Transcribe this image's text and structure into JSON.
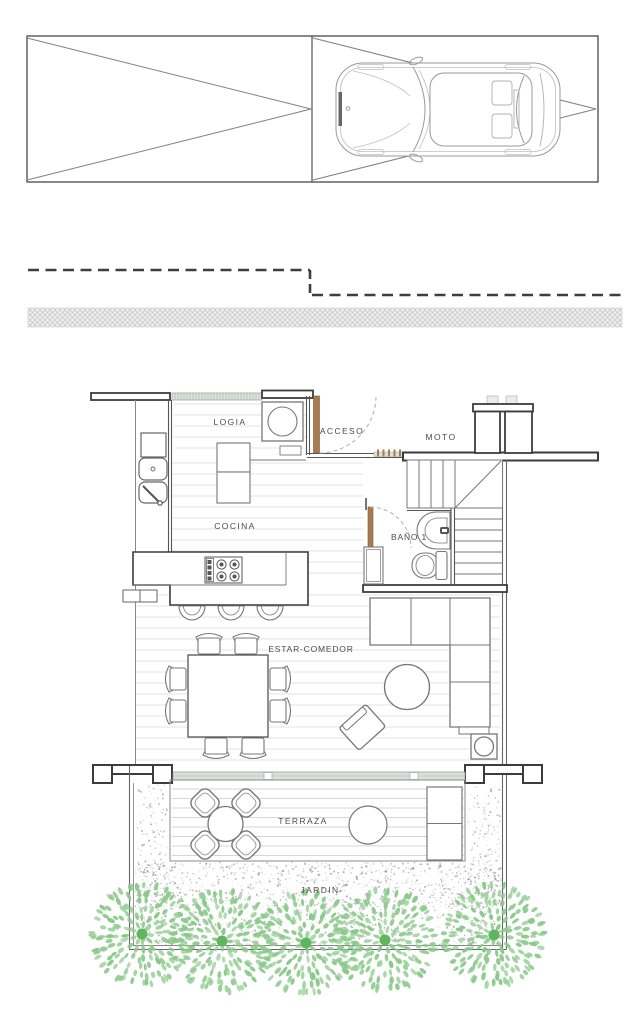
{
  "title": "Planta baja - vivienda",
  "labels": {
    "logia": "LOGIA",
    "acceso": "ACCESO",
    "moto": "MOTO",
    "cocina": "COCINA",
    "bano1": "BAÑO 1",
    "estar_comedor": "ESTAR-COMEDOR",
    "terraza": "TERRAZA",
    "jardin": "JARDIN"
  },
  "colors": {
    "wall": "#3c3c3c",
    "line": "#777777",
    "light_line": "#bbbbbb",
    "plank": "#e3e3e3",
    "terrace_plank": "#d6d6d6",
    "door_wood": "#a87c52",
    "glass_band": "#d9e1da",
    "glass_tick": "#a9b8a9",
    "hatch": "#c4c4c4",
    "stipple": "#8e8e8e",
    "tree_leaf": "#8bc98b",
    "tree_trunk": "#5fb65f"
  },
  "garden": {
    "trees": [
      {
        "x": 142,
        "y": 934,
        "r": 52
      },
      {
        "x": 222,
        "y": 941,
        "r": 50
      },
      {
        "x": 306,
        "y": 943,
        "r": 50
      },
      {
        "x": 385,
        "y": 940,
        "r": 50
      },
      {
        "x": 494,
        "y": 935,
        "r": 56
      }
    ]
  }
}
